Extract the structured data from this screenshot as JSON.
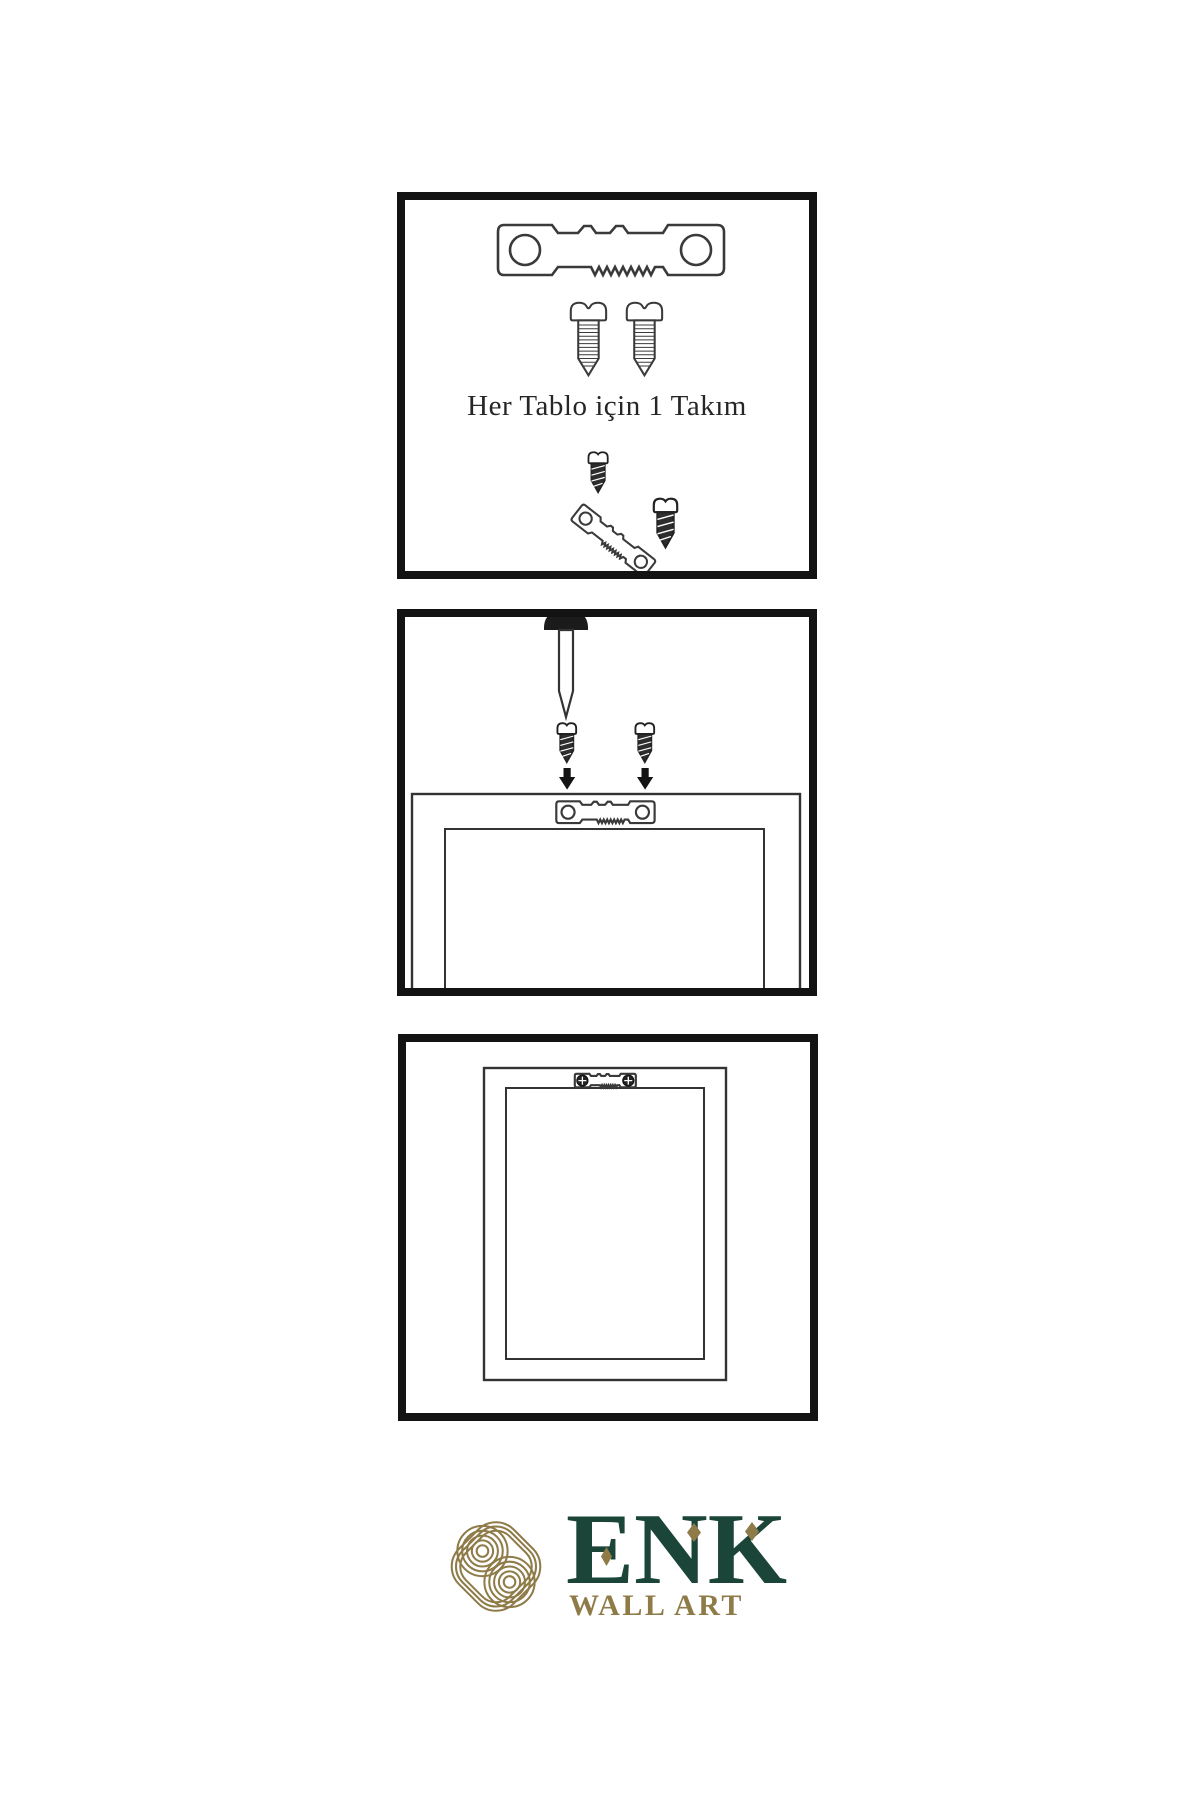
{
  "page": {
    "background_color": "#ffffff",
    "description_icons": [
      "sawtooth-hanger-icon",
      "screw-icon",
      "nail-icon",
      "down-arrow-icon",
      "frame-back-icon",
      "frame-front-icon",
      "knot-logo-icon"
    ]
  },
  "panels": [
    {
      "name": "hardware-kit",
      "caption": "Her Tablo için 1 Takım",
      "icons": [
        "sawtooth-hanger-icon",
        "screw-icon",
        "screw-icon",
        "dark-screw-icon",
        "tilted-hanger-icon",
        "dark-screw-icon"
      ]
    },
    {
      "name": "wall-mounting-step",
      "icons": [
        "nail-icon",
        "dark-screw-icon",
        "dark-screw-icon",
        "down-arrow-icon",
        "down-arrow-icon",
        "frame-back-icon",
        "sawtooth-hanger-icon"
      ]
    },
    {
      "name": "hung-frame-step",
      "icons": [
        "frame-front-icon",
        "mounted-hanger-icon"
      ]
    }
  ],
  "brand": {
    "name": "ENK",
    "subtitle": "WALL ART",
    "logo_icon": "knot-logo-icon",
    "color_green": "#1c4539",
    "color_gold": "#8e7b48",
    "ink_color": "#3a3a3a"
  }
}
